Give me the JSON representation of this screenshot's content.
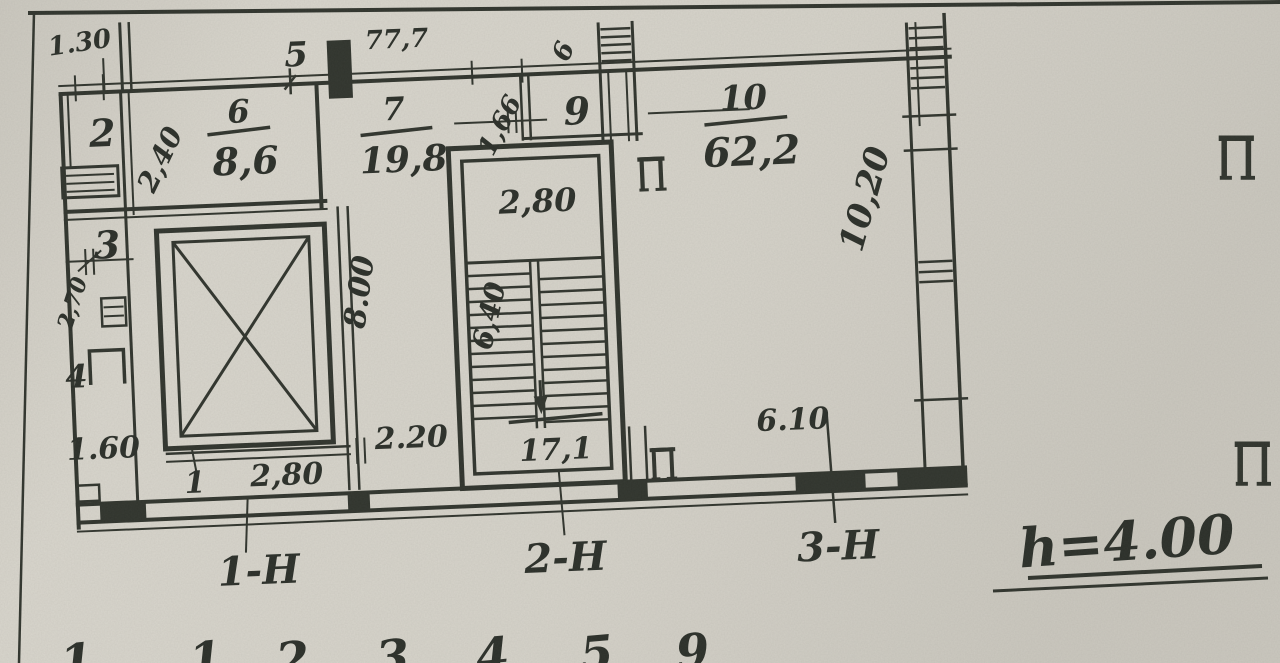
{
  "colors": {
    "paper": "#d7d4cb",
    "ink": "#30342d"
  },
  "plan": {
    "rooms": {
      "r1": {
        "number": "1"
      },
      "r2": {
        "number": "2"
      },
      "r3": {
        "number": "3"
      },
      "r4": {
        "number": "4"
      },
      "r5": {
        "number": "5"
      },
      "r6": {
        "number": "6",
        "area": "8,6"
      },
      "r7": {
        "number": "7",
        "area": "19,8"
      },
      "r9": {
        "number": "9"
      },
      "r10": {
        "number": "10",
        "area": "62,2"
      },
      "stair": {
        "area": "17,1"
      }
    },
    "dims": {
      "d130": "1.30",
      "d240": "2,40",
      "d270": "2,70",
      "d160": "1.60",
      "d777": "77,7",
      "d6": "6",
      "d166": "1,66",
      "d280_stair": "2,80",
      "d640": "6,40",
      "d800": "8.00",
      "d220": "2.20",
      "d280_lobby": "2,80",
      "d1020": "10,20",
      "d610": "6.10"
    },
    "units": {
      "u1": "1-Н",
      "u2": "2-Н",
      "u3": "3-Н"
    },
    "notes": {
      "height": "h=4.00"
    },
    "bottom_row": [
      "1",
      "1",
      "2",
      "3",
      "4",
      "5",
      "9"
    ]
  }
}
